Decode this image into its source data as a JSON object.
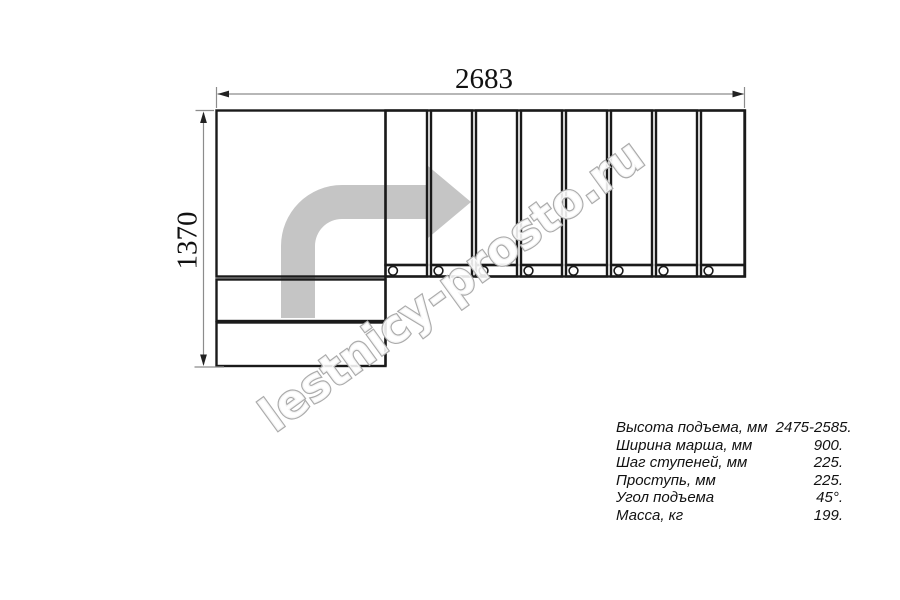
{
  "drawing": {
    "dimension_width_mm": "2683",
    "dimension_height_mm": "1370",
    "upper_steps_count": 8,
    "lower_steps_count": 2
  },
  "watermark": {
    "text": "lestnicy-prosto.ru"
  },
  "specs": {
    "rows": [
      {
        "label": "Высота подъема, мм",
        "value": "2475-2585."
      },
      {
        "label": "Ширина марша, мм",
        "value": "900."
      },
      {
        "label": "Шаг ступеней, мм",
        "value": "225."
      },
      {
        "label": "Проступь, мм",
        "value": "225."
      },
      {
        "label": "Угол подъема",
        "value": "45°."
      },
      {
        "label": "Масса, кг",
        "value": "199."
      }
    ]
  },
  "colors": {
    "background": "#ffffff",
    "line": "#1a1a1a",
    "dimension_line": "#8c8c8c",
    "dimension_arrow": "#222222",
    "text": "#111111",
    "direction_arrow": "#c5c5c5",
    "watermark_stroke": "#ababab"
  }
}
